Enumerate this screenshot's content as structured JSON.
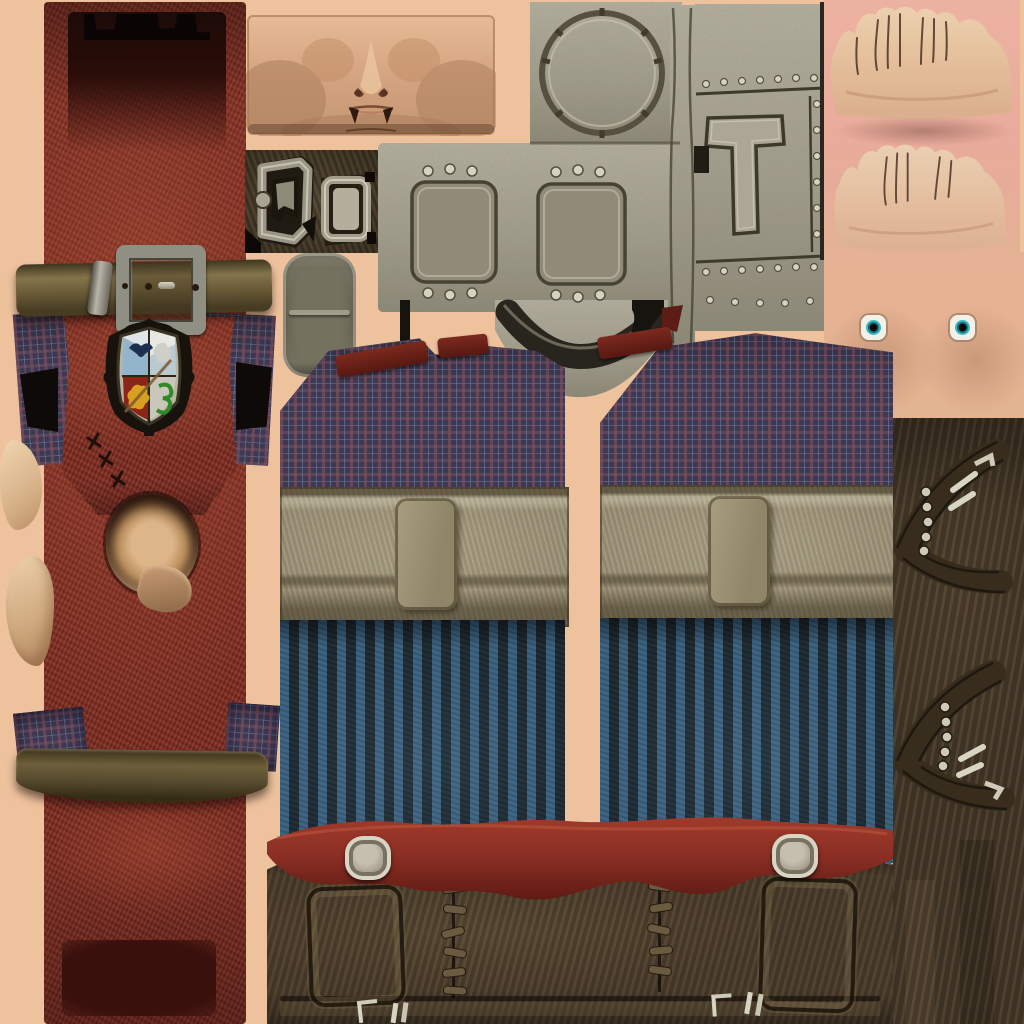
{
  "meta": {
    "kind": "character-texture-atlas",
    "description": "1024x1024 game character UV texture sheet: red leather coat with school crest, plaid shirt panels, khaki waistbands, blue striped trousers, riveted metal chest plate, face / hands / chest skin patches with eyes, red waist belt, brown boot panels with laces and buckled boot straps"
  },
  "colors": {
    "bg-peach": "#eec29d",
    "pink-hands-bg": "#e9ab9b",
    "skin-chest": "#e3b492",
    "face-skin": "#d8a987",
    "coat-red": "#7e2d23",
    "coat-red-light": "#a04434",
    "coat-dark-inset": "#3a100c",
    "coat-top-dark": "#2a0d09",
    "belt-khaki": "#6b5c38",
    "belt-olive-dark": "#564b2e",
    "metal-grey": "#9a9a8e",
    "metal-light": "#d6d2c0",
    "metal-dark": "#4e4e44",
    "hardware-panel-brown": "#473b28",
    "pouch-grey": "#8d897b",
    "plaid-base": "#3e3850",
    "trim-red": "#6e2018",
    "waistband": "#958b72",
    "pants-dark": "#1d2830",
    "pants-blue": "#3a607e",
    "waistbelt-red": "#8c2f25",
    "boots-brown": "#4a3c2b",
    "leather-right": "#453828",
    "stone-light": "#c6c2b2",
    "stone-mid": "#a39e8d",
    "stone-dark": "#55503f",
    "eye-white": "#f2f1e8",
    "iris-teal": "#39b7c6",
    "crest-gold": "#d8a020",
    "crest-green": "#2f8a28",
    "crest-navy": "#1d2f4e",
    "crest-red": "#8c2418"
  },
  "regions": {
    "coat": "red leather coat back strip with upper belt, crest, neck hole, lower belt",
    "upper_belt": "khaki belt with square metal buckle, keeper loop, prong and holes",
    "crest": "quartered school crest: navy bird, grey rabbit, gold lion, green serpent",
    "face": "flattened face skin patch with nose and mouth",
    "hardware": "metal clasp pieces on dark brown backing",
    "pouch": "grey fabric pouch",
    "armor_plate": "riveted stone/metal plate with circular hatch, T-bracket, inset panels and dark collar",
    "hands": "two flattened hand skin patches on pink backing",
    "chest": "chest skin patch with two eye textures",
    "shirt_panels": "two plaid shirt front panels with dark red collar trim",
    "waistbands": "two khaki waistband panels with center strap loop",
    "trousers": "two blue pinstriped trouser panels",
    "waist_belt": "wavy red leather belt with two metal studs",
    "boots": "brown boot band with tongues, lace stitching and metal hooks",
    "boot_straps": "two chevron boot-strap panels with eyelets and buckles on dark leather"
  }
}
